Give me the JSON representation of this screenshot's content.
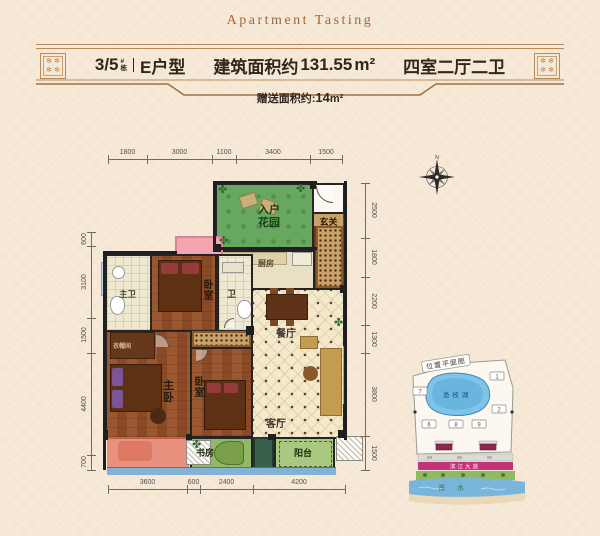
{
  "page": {
    "title": "Apartment Tasting"
  },
  "header": {
    "building_number": "3/5",
    "building_tag_top": "#",
    "building_tag_bottom": "栋",
    "unit_type": "E户型",
    "area_label": "建筑面积约",
    "area_value": "131.55",
    "area_unit": "m²",
    "layout_text": "四室二厅二卫",
    "bonus_label": "赠送面积约:",
    "bonus_value": "14",
    "bonus_unit": "m²"
  },
  "plan": {
    "compass_n": "N",
    "rooms": {
      "entry_garden": "入户花园",
      "foyer": "玄关",
      "kitchen": "厨房",
      "master_bath": "主卫",
      "bedroom_top": "卧室",
      "bath": "卫",
      "dining": "餐厅",
      "living": "客厅",
      "wardrobe": "衣帽间",
      "master_bedroom": "主卧",
      "bedroom_mid": "卧室",
      "study": "书房",
      "balcony": "阳台"
    },
    "dims": {
      "top": [
        "1800",
        "3000",
        "1100",
        "3400",
        "1500"
      ],
      "bottom": [
        "3600",
        "600",
        "2400",
        "4200"
      ],
      "left": [
        "600",
        "3100",
        "1500",
        "4400",
        "700"
      ],
      "right": [
        "2500",
        "1800",
        "2200",
        "1300",
        "3800",
        "1500"
      ]
    }
  },
  "minimap": {
    "title": "位置平面图",
    "lake_label": "渔枝湖",
    "building_numbers": [
      "1",
      "7",
      "2",
      "6",
      "8",
      "9"
    ],
    "road_label": "滨江大道",
    "river_label": "资水"
  }
}
